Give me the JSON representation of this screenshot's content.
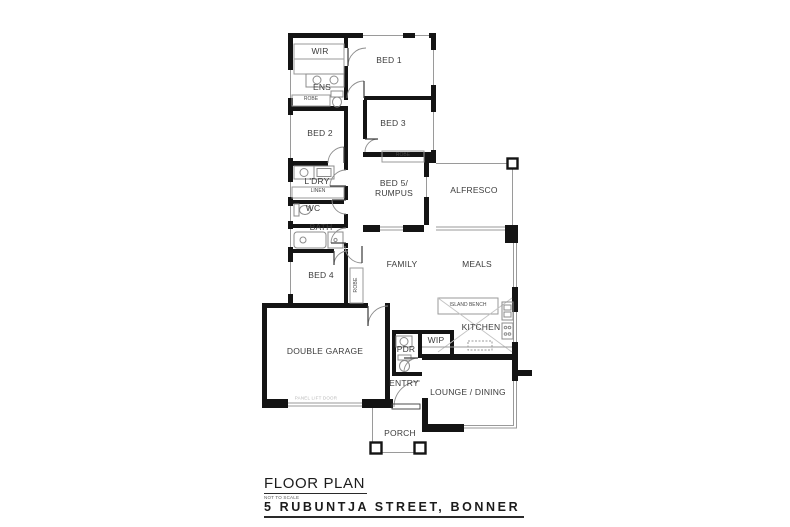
{
  "title_block": {
    "title": "FLOOR PLAN",
    "subtitle": "NOT TO SCALE",
    "address": "5 RUBUNTJA STREET, BONNER"
  },
  "rooms": {
    "wir": "WIR",
    "bed1": "BED 1",
    "ens": "ENS",
    "robe_bed2": "ROBE",
    "bed2": "BED 2",
    "bed3": "BED 3",
    "robe_bed3": "ROBE",
    "ldry": "L'DRY",
    "linen": "LINEN",
    "wc": "WC",
    "bath": "BATH",
    "bed5": "BED 5/\nRUMPUS",
    "alfresco": "ALFRESCO",
    "family": "FAMILY",
    "meals": "MEALS",
    "bed4": "BED 4",
    "robe_bed4": "ROBE",
    "island_bench": "ISLAND BENCH",
    "kitchen": "KITCHEN",
    "wip": "WIP",
    "pdr": "PDR",
    "garage": "DOUBLE GARAGE",
    "entry": "ENTRY",
    "lounge": "LOUNGE / DINING",
    "porch": "PORCH",
    "garage_door": "PANEL LIFT DOOR"
  },
  "colors": {
    "wall": "#141414",
    "thin_line": "#999999",
    "label_text": "#3c3c3c",
    "faint_text": "#b9b9b9",
    "background": "#ffffff"
  }
}
